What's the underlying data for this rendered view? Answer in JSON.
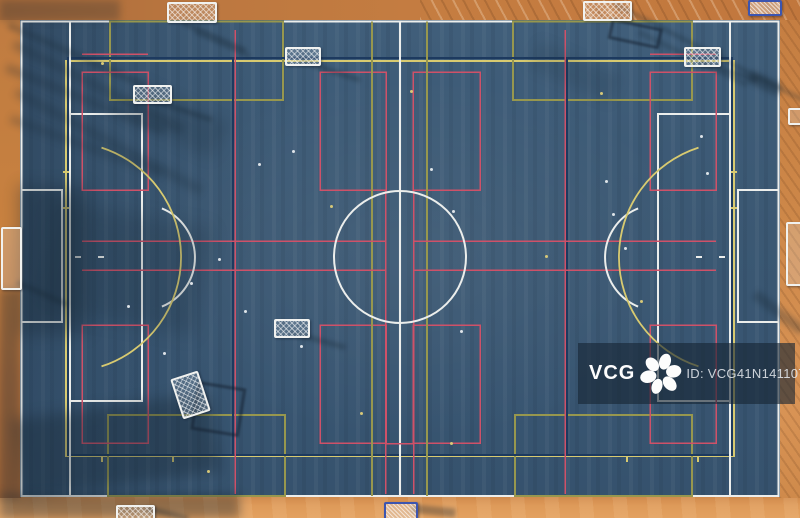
{
  "watermark": {
    "brand": "VCG",
    "id_label": "ID: VCG41N1411075846",
    "bar": {
      "x": 578,
      "y": 343,
      "w": 217,
      "h": 61
    }
  },
  "palette": {
    "court_blue": "#3b5873",
    "ground_orange": "#c8813f",
    "white": "#eceeec",
    "yellow": "#d8ca70",
    "olive": "#97974e",
    "navy": "#1d3a5f",
    "red": "#cf5168",
    "shadow": "#14232f"
  },
  "field_markings": {
    "circles": [
      {
        "cx": 400,
        "cy": 257,
        "r": 66,
        "color": "white"
      }
    ],
    "rects": [
      {
        "x": 21.5,
        "y": 21.5,
        "w": 757,
        "h": 474.5,
        "color": "white"
      },
      {
        "x": 70,
        "y": 114,
        "w": 72,
        "h": 287,
        "color": "white"
      },
      {
        "x": 658,
        "y": 114,
        "w": 72,
        "h": 287,
        "color": "white"
      },
      {
        "x": 21.5,
        "y": 190,
        "w": 40.5,
        "h": 132,
        "color": "white"
      },
      {
        "x": 738,
        "y": 190,
        "w": 40.5,
        "h": 132,
        "color": "white"
      },
      {
        "x": 66,
        "y": 61,
        "w": 668,
        "h": 395,
        "color": "yellow"
      },
      {
        "x": 110,
        "y": 21.5,
        "w": 173,
        "h": 78.5,
        "color": "olive"
      },
      {
        "x": 513,
        "y": 21.5,
        "w": 179,
        "h": 78.5,
        "color": "olive"
      },
      {
        "x": 108,
        "y": 415,
        "w": 177,
        "h": 81,
        "color": "olive"
      },
      {
        "x": 515,
        "y": 415,
        "w": 177,
        "h": 81,
        "color": "olive"
      },
      {
        "x": 68,
        "y": 58,
        "w": 664,
        "h": 397,
        "color": "navy"
      },
      {
        "x": 82,
        "y": 72,
        "w": 66,
        "h": 118,
        "color": "red"
      },
      {
        "x": 320,
        "y": 72,
        "w": 66,
        "h": 118,
        "color": "red"
      },
      {
        "x": 413,
        "y": 72,
        "w": 67,
        "h": 118,
        "color": "red"
      },
      {
        "x": 650,
        "y": 72,
        "w": 66,
        "h": 118,
        "color": "red"
      },
      {
        "x": 82,
        "y": 325,
        "w": 66,
        "h": 118,
        "color": "red"
      },
      {
        "x": 320,
        "y": 325,
        "w": 66,
        "h": 118,
        "color": "red"
      },
      {
        "x": 413,
        "y": 325,
        "w": 67,
        "h": 118,
        "color": "red"
      },
      {
        "x": 650,
        "y": 325,
        "w": 66,
        "h": 118,
        "color": "red"
      }
    ],
    "lines": [
      {
        "x1": 70,
        "y1": 21.5,
        "x2": 70,
        "y2": 496,
        "color": "white"
      },
      {
        "x1": 730,
        "y1": 21.5,
        "x2": 730,
        "y2": 496,
        "color": "white"
      },
      {
        "x1": 400,
        "y1": 21.5,
        "x2": 400,
        "y2": 496,
        "color": "white"
      },
      {
        "x1": 75,
        "y1": 257,
        "x2": 81,
        "y2": 257,
        "color": "white"
      },
      {
        "x1": 98,
        "y1": 257,
        "x2": 104,
        "y2": 257,
        "color": "white"
      },
      {
        "x1": 696,
        "y1": 257,
        "x2": 702,
        "y2": 257,
        "color": "white"
      },
      {
        "x1": 719,
        "y1": 257,
        "x2": 725,
        "y2": 257,
        "color": "white"
      },
      {
        "x1": 372,
        "y1": 21.5,
        "x2": 372,
        "y2": 496,
        "color": "olive"
      },
      {
        "x1": 427,
        "y1": 21.5,
        "x2": 427,
        "y2": 496,
        "color": "olive"
      },
      {
        "x1": 233,
        "y1": 58,
        "x2": 233,
        "y2": 455,
        "color": "navy"
      },
      {
        "x1": 567,
        "y1": 58,
        "x2": 567,
        "y2": 455,
        "color": "navy"
      },
      {
        "x1": 82,
        "y1": 241,
        "x2": 385,
        "y2": 241,
        "color": "red"
      },
      {
        "x1": 414,
        "y1": 241,
        "x2": 716,
        "y2": 241,
        "color": "red"
      },
      {
        "x1": 82,
        "y1": 270,
        "x2": 385,
        "y2": 270,
        "color": "red"
      },
      {
        "x1": 414,
        "y1": 270,
        "x2": 716,
        "y2": 270,
        "color": "red"
      },
      {
        "x1": 235,
        "y1": 30,
        "x2": 235,
        "y2": 494,
        "color": "red"
      },
      {
        "x1": 565,
        "y1": 30,
        "x2": 565,
        "y2": 494,
        "color": "red"
      },
      {
        "x1": 385.5,
        "y1": 190,
        "x2": 385.5,
        "y2": 494,
        "color": "red"
      },
      {
        "x1": 413.5,
        "y1": 190,
        "x2": 413.5,
        "y2": 494,
        "color": "red"
      },
      {
        "x1": 386,
        "y1": 443.5,
        "x2": 413,
        "y2": 443.5,
        "color": "red"
      },
      {
        "x1": 82,
        "y1": 54,
        "x2": 148,
        "y2": 54,
        "color": "red"
      },
      {
        "x1": 650,
        "y1": 54,
        "x2": 716,
        "y2": 54,
        "color": "red"
      },
      {
        "x1": 731,
        "y1": 172,
        "x2": 737,
        "y2": 172,
        "color": "yellow"
      },
      {
        "x1": 731,
        "y1": 208,
        "x2": 737,
        "y2": 208,
        "color": "yellow"
      },
      {
        "x1": 63,
        "y1": 172,
        "x2": 69,
        "y2": 172,
        "color": "yellow"
      },
      {
        "x1": 63,
        "y1": 208,
        "x2": 69,
        "y2": 208,
        "color": "yellow"
      },
      {
        "x1": 102,
        "y1": 456,
        "x2": 102,
        "y2": 462,
        "color": "yellow"
      },
      {
        "x1": 173,
        "y1": 456,
        "x2": 173,
        "y2": 462,
        "color": "yellow"
      },
      {
        "x1": 627,
        "y1": 456,
        "x2": 627,
        "y2": 462,
        "color": "yellow"
      },
      {
        "x1": 698,
        "y1": 456,
        "x2": 698,
        "y2": 462,
        "color": "yellow"
      }
    ],
    "arcs": [
      {
        "d": "M161.9,208.4 A53,53 0 0 1 161.9,306.6",
        "color": "white"
      },
      {
        "d": "M638.1,208.4 A53,53 0 0 0 638.1,306.6",
        "color": "white"
      },
      {
        "d": "M101.5,147.6 A115,115 0 0 1 101.5,366.4",
        "color": "yellow"
      },
      {
        "d": "M698.5,147.6 A115,115 0 0 0 698.5,366.4",
        "color": "yellow"
      }
    ]
  },
  "goals": [
    {
      "x": 167,
      "y": 2,
      "w": 46,
      "h": 17,
      "rot": 0,
      "variant": "white",
      "name": "goal-top-left"
    },
    {
      "x": 583,
      "y": 1,
      "w": 45,
      "h": 16,
      "rot": 0,
      "variant": "white",
      "name": "goal-top-center"
    },
    {
      "x": 748,
      "y": 0,
      "w": 30,
      "h": 12,
      "rot": 0,
      "variant": "blue",
      "name": "goal-top-right"
    },
    {
      "x": 133,
      "y": 85,
      "w": 35,
      "h": 15,
      "rot": 0,
      "variant": "white",
      "name": "mini-goal-upper-left"
    },
    {
      "x": 285,
      "y": 47,
      "w": 32,
      "h": 15,
      "rot": 0,
      "variant": "white",
      "name": "mini-goal-upper-center"
    },
    {
      "x": 684,
      "y": 47,
      "w": 33,
      "h": 16,
      "rot": 0,
      "variant": "white",
      "name": "mini-goal-upper-right"
    },
    {
      "x": 176,
      "y": 374,
      "w": 25,
      "h": 38,
      "rot": -18,
      "variant": "white",
      "name": "tilted-goal-mid-left"
    },
    {
      "x": 274,
      "y": 319,
      "w": 32,
      "h": 15,
      "rot": 0,
      "variant": "white",
      "name": "mini-goal-lower-left"
    },
    {
      "x": 116,
      "y": 505,
      "w": 35,
      "h": 13,
      "rot": 0,
      "variant": "white",
      "name": "goal-bottom-left"
    },
    {
      "x": 384,
      "y": 502,
      "w": 30,
      "h": 15,
      "rot": 0,
      "variant": "blue",
      "name": "goal-bottom-center"
    },
    {
      "x": 1,
      "y": 227,
      "w": 17,
      "h": 59,
      "rot": 0,
      "variant": "side",
      "name": "goal-left-edge"
    },
    {
      "x": 786,
      "y": 222,
      "w": 13,
      "h": 60,
      "rot": 0,
      "variant": "side",
      "name": "goal-right-edge"
    },
    {
      "x": 788,
      "y": 108,
      "w": 11,
      "h": 13,
      "rot": 0,
      "variant": "side",
      "name": "bench-right-edge"
    }
  ],
  "shadows": [
    {
      "x": 10,
      "y": 22,
      "w": 150,
      "h": 7,
      "rot": 24,
      "op": 0.26,
      "blur": 3
    },
    {
      "x": 16,
      "y": 40,
      "w": 190,
      "h": 9,
      "rot": 27,
      "op": 0.24,
      "blur": 4
    },
    {
      "x": 8,
      "y": 64,
      "w": 170,
      "h": 8,
      "rot": 22,
      "op": 0.26,
      "blur": 4
    },
    {
      "x": 18,
      "y": 88,
      "w": 210,
      "h": 9,
      "rot": 28,
      "op": 0.22,
      "blur": 4
    },
    {
      "x": 12,
      "y": 115,
      "w": 160,
      "h": 8,
      "rot": 20,
      "op": 0.22,
      "blur": 4
    },
    {
      "x": 140,
      "y": 80,
      "w": 100,
      "h": 40,
      "rot": 26,
      "op": 0.16,
      "blur": 7
    },
    {
      "x": 18,
      "y": 185,
      "w": 70,
      "h": 150,
      "rot": 0,
      "op": 0.3,
      "blur": 8
    },
    {
      "x": 55,
      "y": 200,
      "w": 160,
      "h": 110,
      "rot": 10,
      "op": 0.18,
      "blur": 9
    },
    {
      "x": 12,
      "y": 420,
      "w": 200,
      "h": 80,
      "rot": -8,
      "op": 0.34,
      "blur": 7
    },
    {
      "x": 0,
      "y": 494,
      "w": 240,
      "h": 24,
      "rot": 0,
      "op": 0.38,
      "blur": 5
    },
    {
      "x": 615,
      "y": 2,
      "w": 215,
      "h": 4,
      "rot": 27,
      "op": 0.3,
      "blur": 2
    },
    {
      "x": 640,
      "y": 30,
      "w": 120,
      "h": 5,
      "rot": 26,
      "op": 0.22,
      "blur": 2
    },
    {
      "x": 540,
      "y": 40,
      "w": 90,
      "h": 30,
      "rot": 24,
      "op": 0.12,
      "blur": 6
    },
    {
      "x": 612,
      "y": 18,
      "w": 46,
      "h": 15,
      "rot": 12,
      "op": 0.45,
      "blur": 1,
      "frame": true
    },
    {
      "x": 183,
      "y": 20,
      "w": 70,
      "h": 5,
      "rot": 24,
      "op": 0.3,
      "blur": 2
    },
    {
      "x": 196,
      "y": 30,
      "w": 60,
      "h": 4,
      "rot": 24,
      "op": 0.25,
      "blur": 2
    },
    {
      "x": 150,
      "y": 97,
      "w": 66,
      "h": 5,
      "rot": 18,
      "op": 0.3,
      "blur": 2
    },
    {
      "x": 300,
      "y": 58,
      "w": 64,
      "h": 5,
      "rot": 18,
      "op": 0.3,
      "blur": 2
    },
    {
      "x": 700,
      "y": 59,
      "w": 62,
      "h": 5,
      "rot": 18,
      "op": 0.3,
      "blur": 2
    },
    {
      "x": 290,
      "y": 330,
      "w": 58,
      "h": 5,
      "rot": 15,
      "op": 0.3,
      "blur": 2
    },
    {
      "x": 198,
      "y": 381,
      "w": 43,
      "h": 43,
      "rot": 9,
      "op": 0.45,
      "blur": 1,
      "frame": true
    },
    {
      "x": 148,
      "y": 506,
      "w": 42,
      "h": 5,
      "rot": 14,
      "op": 0.35,
      "blur": 2
    },
    {
      "x": 412,
      "y": 504,
      "w": 44,
      "h": 9,
      "rot": 6,
      "op": 0.32,
      "blur": 2
    },
    {
      "x": 18,
      "y": 280,
      "w": 55,
      "h": 5,
      "rot": 24,
      "op": 0.3,
      "blur": 2
    },
    {
      "x": 758,
      "y": 290,
      "w": 60,
      "h": 10,
      "rot": 38,
      "op": 0.28,
      "blur": 3
    },
    {
      "x": 752,
      "y": 70,
      "w": 34,
      "h": 13,
      "rot": 25,
      "op": 0.35,
      "blur": 3
    },
    {
      "x": 0,
      "y": 0,
      "w": 120,
      "h": 21,
      "rot": 0,
      "op": 0.25,
      "blur": 4
    },
    {
      "x": 0,
      "y": 290,
      "w": 20,
      "h": 210,
      "rot": 0,
      "op": 0.3,
      "blur": 4
    }
  ],
  "paint_dots": [
    {
      "x": 127,
      "y": 305,
      "c": "white"
    },
    {
      "x": 163,
      "y": 352,
      "c": "white"
    },
    {
      "x": 190,
      "y": 282,
      "c": "white"
    },
    {
      "x": 218,
      "y": 258,
      "c": "white"
    },
    {
      "x": 244,
      "y": 310,
      "c": "white"
    },
    {
      "x": 292,
      "y": 150,
      "c": "white"
    },
    {
      "x": 258,
      "y": 163,
      "c": "white"
    },
    {
      "x": 300,
      "y": 345,
      "c": "white"
    },
    {
      "x": 430,
      "y": 168,
      "c": "white"
    },
    {
      "x": 452,
      "y": 210,
      "c": "white"
    },
    {
      "x": 605,
      "y": 180,
      "c": "white"
    },
    {
      "x": 612,
      "y": 213,
      "c": "white"
    },
    {
      "x": 624,
      "y": 247,
      "c": "white"
    },
    {
      "x": 700,
      "y": 135,
      "c": "white"
    },
    {
      "x": 706,
      "y": 172,
      "c": "white"
    },
    {
      "x": 460,
      "y": 330,
      "c": "white"
    },
    {
      "x": 101,
      "y": 62,
      "c": "yellow"
    },
    {
      "x": 330,
      "y": 205,
      "c": "yellow"
    },
    {
      "x": 600,
      "y": 92,
      "c": "yellow"
    },
    {
      "x": 640,
      "y": 300,
      "c": "yellow"
    },
    {
      "x": 450,
      "y": 442,
      "c": "yellow"
    },
    {
      "x": 360,
      "y": 412,
      "c": "yellow"
    },
    {
      "x": 207,
      "y": 470,
      "c": "yellow"
    },
    {
      "x": 545,
      "y": 255,
      "c": "yellow"
    },
    {
      "x": 410,
      "y": 90,
      "c": "yellow"
    }
  ]
}
